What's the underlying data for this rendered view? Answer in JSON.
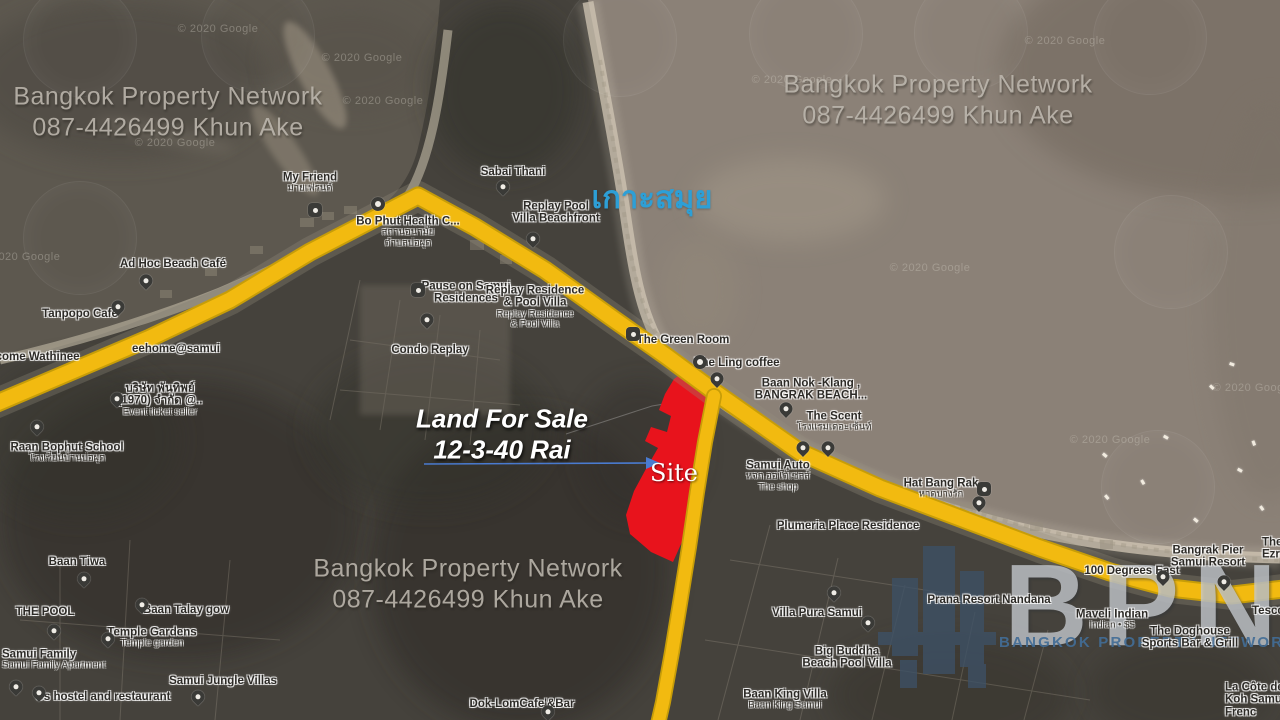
{
  "watermarks": {
    "brand_line": "Bangkok Property Network",
    "phone_line": "087-4426499  Khun Ake",
    "positions": [
      {
        "x": 168,
        "y": 112
      },
      {
        "x": 938,
        "y": 100
      },
      {
        "x": 468,
        "y": 584
      }
    ]
  },
  "annotations": {
    "sale_line1": "Land For Sale",
    "sale_line2": "12-3-40 Rai",
    "site_label": "Site",
    "island_label": "เกาะสมุย"
  },
  "logo": {
    "acronym": "BPN",
    "subtitle": "BANGKOK PROPERTY NETWORK",
    "building_icon": "city-buildings-icon"
  },
  "credits": {
    "text": "© 2020 Google",
    "positions": [
      {
        "x": 218,
        "y": 29
      },
      {
        "x": 362,
        "y": 58
      },
      {
        "x": 383,
        "y": 101
      },
      {
        "x": 175,
        "y": 143
      },
      {
        "x": 20,
        "y": 257
      },
      {
        "x": 792,
        "y": 80
      },
      {
        "x": 1065,
        "y": 41
      },
      {
        "x": 930,
        "y": 268
      },
      {
        "x": 1110,
        "y": 440
      },
      {
        "x": 1253,
        "y": 388
      }
    ]
  },
  "map": {
    "colors": {
      "road": "#f2ba10",
      "site_fill": "#e8131c",
      "arrow": "#4a7bd0",
      "island_text": "#2d9fd6",
      "sea": "#8b8177",
      "bay": "#5d584f",
      "land": "#45423c"
    },
    "site_polygon": "685,371 711,385 723,397 714,423 705,459 698,498 690,524 673,562 651,552 630,534 626,515 634,491 647,467 658,448 645,441 651,427 667,432 671,416 659,410 665,394 674,379",
    "main_road": "M-10,406 L70,372 L150,338 L230,300 L310,252 L418,196 L475,227 L545,270 L612,318 L666,356 L716,393 L800,452 L880,488 L960,518 L1040,548 L1110,572 L1170,588 L1232,595 L1292,588",
    "south_road": "M714,396 L705,442 L697,492 L689,547 L681,597 L672,652 L663,702 L658,724",
    "emblems": [
      {
        "x": 80,
        "y": 40
      },
      {
        "x": 258,
        "y": 36
      },
      {
        "x": 620,
        "y": 40
      },
      {
        "x": 806,
        "y": 34
      },
      {
        "x": 971,
        "y": 33
      },
      {
        "x": 1150,
        "y": 38
      },
      {
        "x": 80,
        "y": 238
      },
      {
        "x": 1171,
        "y": 252
      },
      {
        "x": 1158,
        "y": 487
      }
    ],
    "boats": [
      {
        "x": 1105,
        "y": 455,
        "r": 40
      },
      {
        "x": 1143,
        "y": 482,
        "r": 60
      },
      {
        "x": 1166,
        "y": 437,
        "r": 30
      },
      {
        "x": 1107,
        "y": 497,
        "r": 50
      },
      {
        "x": 1212,
        "y": 387,
        "r": 45
      },
      {
        "x": 1232,
        "y": 364,
        "r": 20
      },
      {
        "x": 1254,
        "y": 443,
        "r": 70
      },
      {
        "x": 1196,
        "y": 520,
        "r": 40
      },
      {
        "x": 1262,
        "y": 508,
        "r": 55
      },
      {
        "x": 1240,
        "y": 470,
        "r": 30
      }
    ],
    "pois": [
      {
        "lines": [
          "My Friend"
        ],
        "sub": [
          "มายเฟรนด์"
        ],
        "x": 310,
        "y": 183,
        "pins": [
          {
            "t": "sq",
            "icon": "restaurant",
            "x": 315,
            "y": 210
          },
          {
            "t": "dot",
            "icon": "poi-dot",
            "x": 378,
            "y": 204
          }
        ]
      },
      {
        "lines": [
          "Sabai Thani"
        ],
        "x": 513,
        "y": 172,
        "pins": [
          {
            "t": "drop",
            "icon": "place-pin",
            "x": 503,
            "y": 192
          }
        ]
      },
      {
        "lines": [
          "Replay Pool",
          "Villa Beachfront"
        ],
        "x": 556,
        "y": 213,
        "pins": [
          {
            "t": "drop",
            "icon": "lodging-pin",
            "x": 533,
            "y": 244
          }
        ]
      },
      {
        "lines": [
          "Bo Phut Health C..."
        ],
        "sub": [
          "สถานอนามัย",
          "ตำบลบ่อผุด"
        ],
        "x": 408,
        "y": 232
      },
      {
        "lines": [
          "Ad Hoc Beach Café"
        ],
        "x": 173,
        "y": 264,
        "pins": [
          {
            "t": "drop",
            "icon": "restaurant-pin",
            "x": 146,
            "y": 286
          }
        ]
      },
      {
        "lines": [
          "Tanpopo Cafe"
        ],
        "x": 80,
        "y": 314,
        "pins": [
          {
            "t": "drop",
            "icon": "cafe-pin",
            "x": 118,
            "y": 312
          }
        ]
      },
      {
        "lines": [
          "eehome@samui"
        ],
        "x": 176,
        "y": 349
      },
      {
        "lines": [
          "lcome Wathinee"
        ],
        "x": 36,
        "y": 357
      },
      {
        "lines": [
          "Pause on Samui",
          "Residences"
        ],
        "x": 466,
        "y": 293,
        "pins": [
          {
            "t": "sq",
            "icon": "lodging",
            "x": 418,
            "y": 290
          }
        ]
      },
      {
        "lines": [
          "Replay Residence",
          "& Pool Villa"
        ],
        "sub": [
          "Replay Residence",
          "& Pool Villa"
        ],
        "x": 535,
        "y": 307
      },
      {
        "lines": [
          "Condo Replay"
        ],
        "x": 430,
        "y": 350,
        "pins": [
          {
            "t": "drop",
            "icon": "place-pin",
            "x": 427,
            "y": 325
          }
        ]
      },
      {
        "lines": [
          "The Green Room"
        ],
        "x": 683,
        "y": 340,
        "pins": [
          {
            "t": "sq",
            "icon": "restaurant",
            "x": 633,
            "y": 334
          }
        ]
      },
      {
        "lines": [
          "The Ling coffee"
        ],
        "x": 737,
        "y": 363,
        "pins": [
          {
            "t": "dot",
            "icon": "poi-dot",
            "x": 700,
            "y": 362
          },
          {
            "t": "drop",
            "icon": "cafe-pin",
            "x": 717,
            "y": 384
          }
        ]
      },
      {
        "lines": [
          "Baan Nok -Klang ,",
          "BANGRAK BEACH..."
        ],
        "x": 811,
        "y": 390,
        "pins": [
          {
            "t": "drop",
            "icon": "lodging-pin",
            "x": 786,
            "y": 414
          }
        ]
      },
      {
        "lines": [
          "The Scent"
        ],
        "sub": [
          "โรงแรมเดอะเซ้นท์"
        ],
        "x": 834,
        "y": 422
      },
      {
        "lines": [
          "บริษัท พันทิพย์",
          "(1970) จำกัด @.."
        ],
        "sub": [
          "Event ticket seller"
        ],
        "x": 160,
        "y": 400,
        "pins": [
          {
            "t": "drop",
            "icon": "shopping-pin",
            "x": 117,
            "y": 404
          }
        ]
      },
      {
        "lines": [
          "Raan Bophut School"
        ],
        "sub": [
          "โรงเรียนบ้านบ่อผุด"
        ],
        "x": 67,
        "y": 453,
        "pins": [
          {
            "t": "drop",
            "icon": "school-pin",
            "x": 37,
            "y": 432
          }
        ]
      },
      {
        "lines": [
          "Samui Auto"
        ],
        "sub": [
          "หจก.ออโต้เซลส์",
          "The shop"
        ],
        "x": 778,
        "y": 476,
        "pins": [
          {
            "t": "drop",
            "icon": "place-pin",
            "x": 803,
            "y": 453
          },
          {
            "t": "drop",
            "icon": "place-pin",
            "x": 828,
            "y": 453
          }
        ]
      },
      {
        "lines": [
          "Hat Bang Rak"
        ],
        "sub": [
          "หาดบางรัก"
        ],
        "x": 941,
        "y": 489,
        "pins": [
          {
            "t": "sq",
            "icon": "camera",
            "x": 984,
            "y": 489
          },
          {
            "t": "drop",
            "icon": "beach-pin",
            "x": 979,
            "y": 508
          }
        ]
      },
      {
        "lines": [
          "Plumeria Place Residence"
        ],
        "x": 848,
        "y": 526
      },
      {
        "lines": [
          "Baan Tiwa"
        ],
        "x": 77,
        "y": 562,
        "pins": [
          {
            "t": "drop",
            "icon": "place-pin",
            "x": 84,
            "y": 584
          }
        ]
      },
      {
        "lines": [
          "THE POOL"
        ],
        "x": 45,
        "y": 612,
        "pins": [
          {
            "t": "drop",
            "icon": "place-pin",
            "x": 54,
            "y": 636
          }
        ]
      },
      {
        "lines": [
          "Baan Talay gow"
        ],
        "x": 186,
        "y": 610,
        "pins": [
          {
            "t": "drop",
            "icon": "lodging-pin",
            "x": 142,
            "y": 610
          }
        ]
      },
      {
        "lines": [
          "Temple Gardens"
        ],
        "sub": [
          "Temple garden"
        ],
        "x": 152,
        "y": 638,
        "pins": [
          {
            "t": "drop",
            "icon": "place-pin",
            "x": 108,
            "y": 644
          }
        ]
      },
      {
        "lines": [
          "Samui Family"
        ],
        "sub": [
          "Samui Family Apartment"
        ],
        "anchor": "left",
        "x": 2,
        "y": 660,
        "pins": [
          {
            "t": "drop",
            "icon": "lodging-pin",
            "x": 16,
            "y": 692
          }
        ]
      },
      {
        "lines": [
          "Us hostel and restaurant"
        ],
        "x": 103,
        "y": 697,
        "pins": [
          {
            "t": "drop",
            "icon": "lodging-pin",
            "x": 39,
            "y": 698
          }
        ]
      },
      {
        "lines": [
          "Samui Jungle Villas"
        ],
        "x": 223,
        "y": 681,
        "pins": [
          {
            "t": "drop",
            "icon": "place-pin",
            "x": 198,
            "y": 702
          }
        ]
      },
      {
        "lines": [
          "Dok-LomCafe'&Bar"
        ],
        "x": 522,
        "y": 704,
        "pins": [
          {
            "t": "drop",
            "icon": "cafe-pin",
            "x": 548,
            "y": 717
          }
        ]
      },
      {
        "lines": [
          "Villa Pura Samui"
        ],
        "x": 817,
        "y": 613,
        "pins": [
          {
            "t": "drop",
            "icon": "place-pin",
            "x": 834,
            "y": 598
          }
        ]
      },
      {
        "lines": [
          "Big Buddha",
          "Beach Pool Villa"
        ],
        "x": 847,
        "y": 658,
        "pins": [
          {
            "t": "drop",
            "icon": "lodging-pin",
            "x": 868,
            "y": 628
          }
        ]
      },
      {
        "lines": [
          "Baan King Villa"
        ],
        "sub": [
          "Baan King Samui"
        ],
        "x": 785,
        "y": 700
      },
      {
        "lines": [
          "Prana Resort Nandana"
        ],
        "x": 989,
        "y": 600
      },
      {
        "lines": [
          "100 Degrees East"
        ],
        "x": 1132,
        "y": 571
      },
      {
        "lines": [
          "Bangrak Pier",
          "Samui Resort"
        ],
        "x": 1208,
        "y": 557,
        "pins": [
          {
            "t": "drop",
            "icon": "place-pin",
            "x": 1163,
            "y": 582
          },
          {
            "t": "drop",
            "icon": "place-pin",
            "x": 1224,
            "y": 587
          }
        ]
      },
      {
        "lines": [
          "The",
          "Ezra"
        ],
        "anchor": "left",
        "x": 1262,
        "y": 549
      },
      {
        "lines": [
          "Tesco"
        ],
        "anchor": "left",
        "x": 1252,
        "y": 611
      },
      {
        "lines": [
          "Maveli Indian"
        ],
        "sub": [
          "Indian • $$"
        ],
        "x": 1112,
        "y": 620
      },
      {
        "lines": [
          "The Doghouse",
          "Sports Bar & Grill"
        ],
        "x": 1190,
        "y": 638
      },
      {
        "lines": [
          "La Côte de B",
          "Koh Samui",
          "Frenc"
        ],
        "anchor": "left",
        "x": 1225,
        "y": 700
      }
    ]
  }
}
